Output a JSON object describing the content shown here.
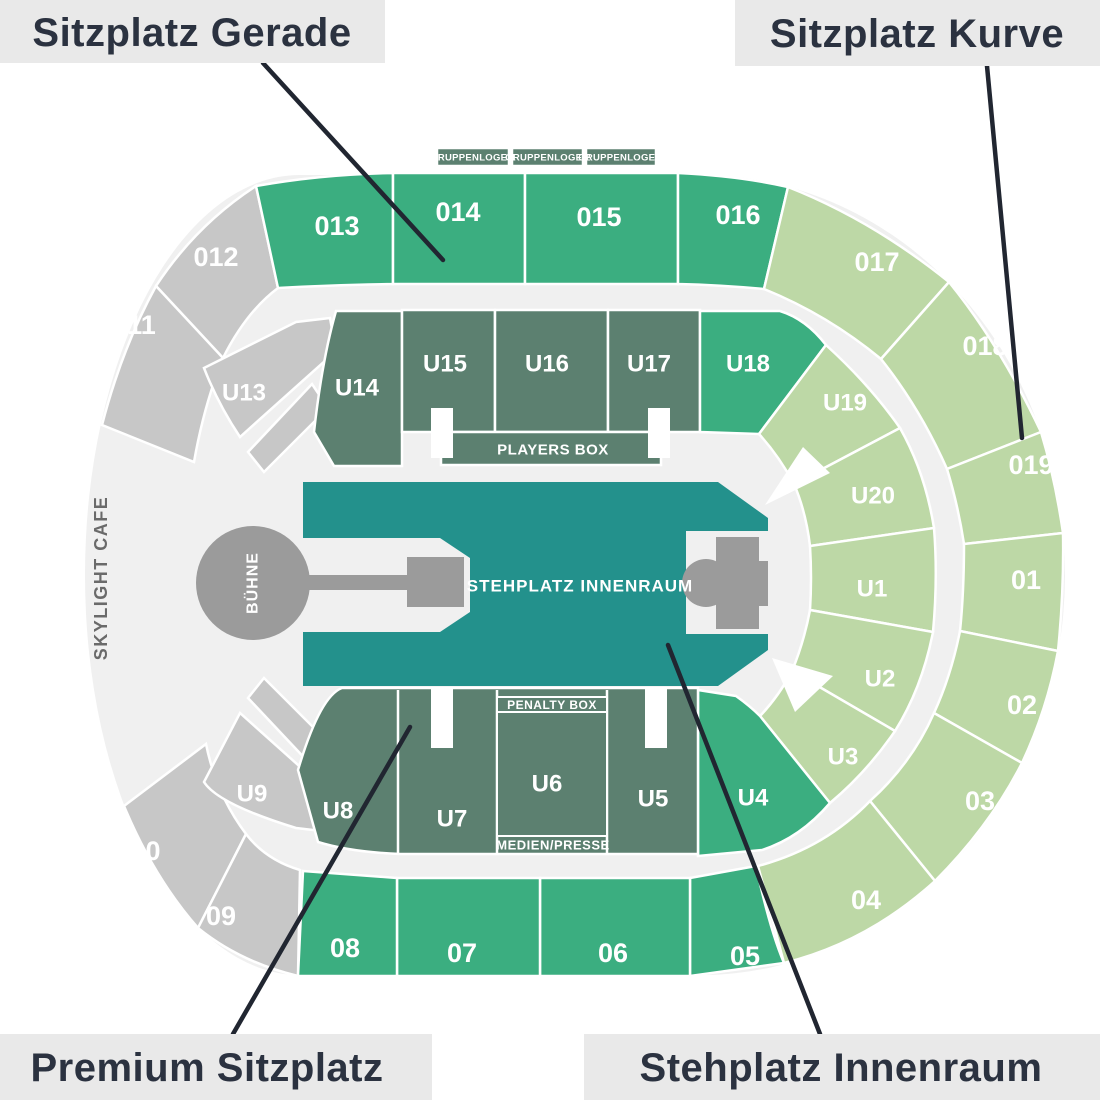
{
  "legend": {
    "top_left": "Sitzplatz Gerade",
    "top_right": "Sitzplatz Kurve",
    "bottom_left": "Premium Sitzplatz",
    "bottom_right": "Stehplatz Innenraum"
  },
  "colors": {
    "base": "#f0f0f0",
    "medium_green": "#3bae80",
    "light_green": "#bdd8a6",
    "dark_sage": "#5c8070",
    "gray_section": "#c7c7c7",
    "teal": "#23918c",
    "stage_gray": "#9b9b9b",
    "white": "#ffffff",
    "label_box_bg": "#e9e9e9",
    "label_text": "#2b3240",
    "leader_line": "#212631",
    "cafe_text": "#6a6a6a"
  },
  "sections": {
    "013": "013",
    "014": "014",
    "015": "015",
    "016": "016",
    "017": "017",
    "018": "018",
    "019": "019",
    "01": "01",
    "02": "02",
    "03": "03",
    "04": "04",
    "05": "05",
    "06": "06",
    "07": "07",
    "08": "08",
    "09": "09",
    "010": "010",
    "011": "011",
    "012": "012",
    "U1": "U1",
    "U2": "U2",
    "U3": "U3",
    "U4": "U4",
    "U5": "U5",
    "U6": "U6",
    "U7": "U7",
    "U8": "U8",
    "U9": "U9",
    "U13": "U13",
    "U14": "U14",
    "U15": "U15",
    "U16": "U16",
    "U17": "U17",
    "U18": "U18",
    "U19": "U19",
    "U20": "U20"
  },
  "areas": {
    "gruppenloge_1": "GRUPPENLOGE 1",
    "gruppenloge_2": "GRUPPENLOGE 2",
    "gruppenloge_3": "GRUPPENLOGE 3",
    "players_box": "PLAYERS BOX",
    "penalty_box": "PENALTY BOX",
    "medien_presse": "MEDIEN/PRESSE",
    "stehplatz_innenraum": "STEHPLATZ INNENRAUM",
    "buehne": "BÜHNE",
    "skylight_cafe": "SKYLIGHT CAFE"
  }
}
